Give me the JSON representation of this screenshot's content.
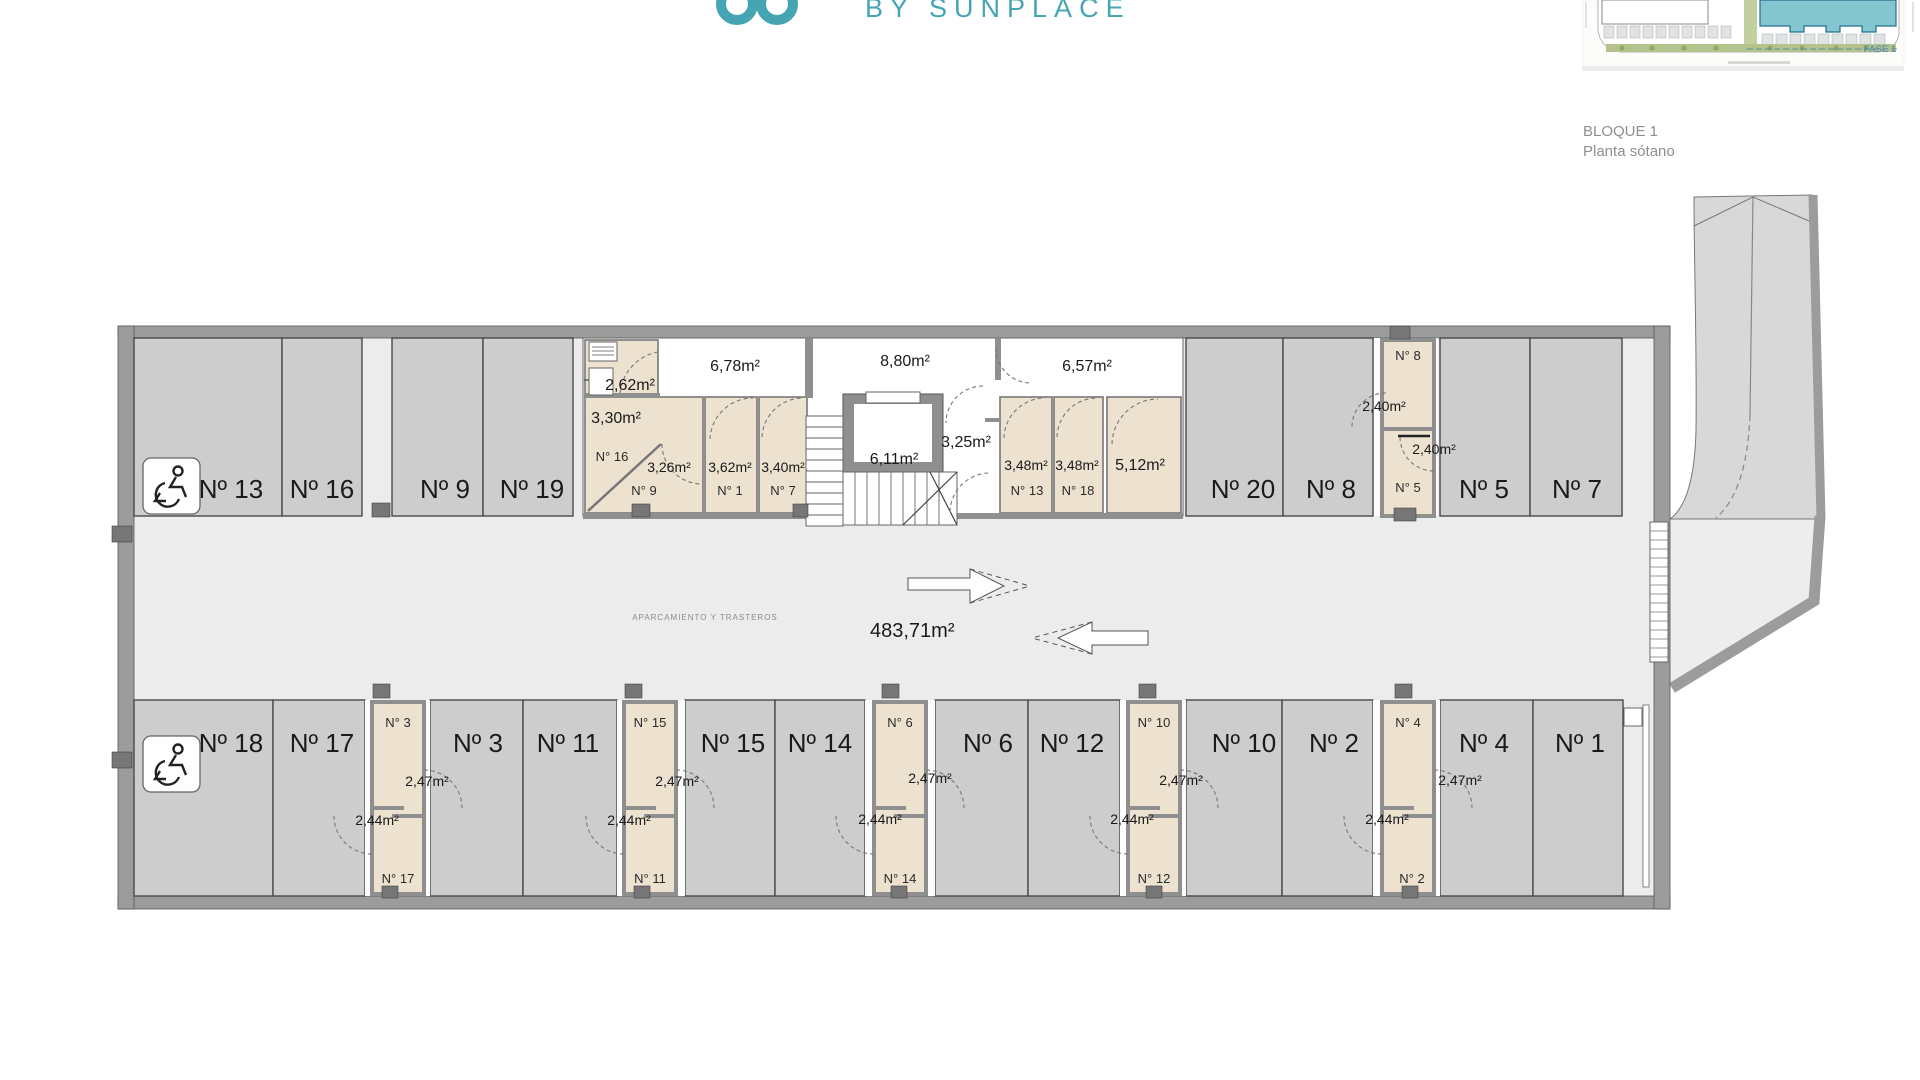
{
  "header": {
    "brand": "BY SUNPLACE",
    "brand_color": "#46a5b2"
  },
  "title_block": {
    "line1": "BLOQUE 1",
    "line2": "Planta sótano"
  },
  "site_map": {
    "fase_label": "FASE 1"
  },
  "plan": {
    "zone_label": "APARCAMIENTO Y TRASTEROS",
    "total_area": "483,71m²",
    "top_row": {
      "p13": "Nº 13",
      "p16": "Nº 16",
      "p9": "Nº 9",
      "p19": "Nº 19",
      "p20": "Nº 20",
      "p8": "Nº 8",
      "p5": "Nº 5",
      "p7": "Nº 7"
    },
    "bottom_row": {
      "p18": "Nº 18",
      "p17": "Nº 17",
      "p3": "Nº 3",
      "p11": "Nº 11",
      "p15": "Nº 15",
      "p14": "Nº 14",
      "p6": "Nº 6",
      "p12": "Nº 12",
      "p10": "Nº 10",
      "p2": "Nº 2",
      "p4": "Nº 4",
      "p1": "Nº 1"
    },
    "core": {
      "utility_area": "2,62m²",
      "corridor_left": "6,78m²",
      "corridor_mid": "8,80m²",
      "corridor_right": "6,57m²",
      "lift_area": "6,11m²",
      "lobby_area": "3,25m²",
      "t16_area": "3,30m²",
      "t16": "N° 16",
      "t9_area": "3,26m²",
      "t9": "N° 9",
      "t1_area": "3,62m²",
      "t1": "N° 1",
      "t7_area": "3,40m²",
      "t7": "N° 7",
      "t13_area": "3,48m²",
      "t13": "N° 13",
      "t18_area": "3,48m²",
      "t18": "N° 18",
      "t512_area": "5,12m²"
    },
    "storage_right": {
      "top": "N° 8",
      "top_area": "2,40m²",
      "bottom": "N° 5",
      "bottom_area": "2,40m²"
    },
    "storage_b1": {
      "top": "N° 3",
      "top_area": "2,47m²",
      "bottom": "N° 17",
      "bottom_area": "2,44m²"
    },
    "storage_b2": {
      "top": "N° 15",
      "top_area": "2,47m²",
      "bottom": "N° 11",
      "bottom_area": "2,44m²"
    },
    "storage_b3": {
      "top": "N° 6",
      "top_area": "2,47m²",
      "bottom": "N° 14",
      "bottom_area": "2,44m²"
    },
    "storage_b4": {
      "top": "N° 10",
      "top_area": "2,47m²",
      "bottom": "N° 12",
      "bottom_area": "2,44m²"
    },
    "storage_b5": {
      "top": "N° 4",
      "top_area": "2,47m²",
      "bottom": "N° 2",
      "bottom_area": "2,44m²"
    }
  }
}
